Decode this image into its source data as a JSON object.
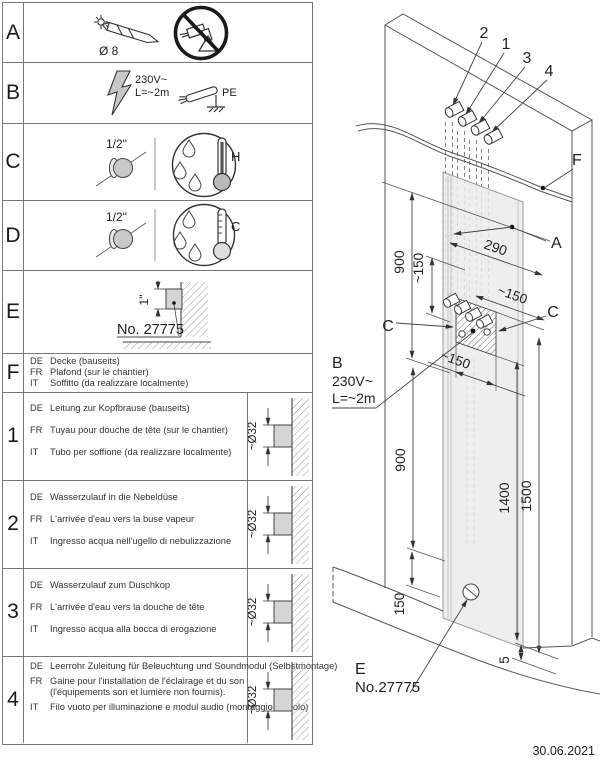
{
  "doc": {
    "date": "30.06.2021"
  },
  "table": {
    "langs": [
      "DE",
      "FR",
      "IT"
    ],
    "rowA": {
      "id": "A",
      "dia": "Ø 8"
    },
    "rowB": {
      "id": "B",
      "volt": "230V~",
      "length": "L=~2m",
      "pe": "PE"
    },
    "rowC": {
      "id": "C",
      "size": "1/2\"",
      "temp": "H"
    },
    "rowD": {
      "id": "D",
      "size": "1/2\"",
      "temp": "C"
    },
    "rowE": {
      "id": "E",
      "inch": "1\"",
      "no": "No. 27775"
    },
    "rowF": {
      "id": "F",
      "de": "Decke (bauseits)",
      "fr": "Plafond (sur le chantier)",
      "it": "Soffitto (da realizzare localmente)"
    },
    "row1": {
      "id": "1",
      "de": "Leitung zur Kopfbrause (bauseits)",
      "fr": "Tuyau pour douche de tête (sur le chantier)",
      "it": "Tubo per soffione (da realizzare localmente)",
      "dia": "~Ø32"
    },
    "row2": {
      "id": "2",
      "de": "Wasserzulauf in die Nebeldüse",
      "fr": "L'arrivée d'eau vers la buse vapeur",
      "it": "Ingresso acqua nell'ugello di nebulizzazione",
      "dia": "~Ø32"
    },
    "row3": {
      "id": "3",
      "de": "Wasserzulauf zum Duschkop",
      "fr": "L'arrivée d'eau vers la douche de tête",
      "it": "Ingresso acqua alla bocca di erogazione",
      "dia": "~Ø32"
    },
    "row4": {
      "id": "4",
      "de": "Leerrohr Zuleitung für Beleuchtung und Soundmodul (Selbstmontage)",
      "fr": "Gaine pour l'installation de l'éclairage et du son",
      "fr2": "(l'équipements son et lumière non fournis).",
      "it": "Filo vuoto per illuminazione e modul audio (montaggio da solo)",
      "dia": "~Ø32"
    }
  },
  "diagram": {
    "pipe2": "2",
    "pipe1": "1",
    "pipe3": "3",
    "pipe4": "4",
    "f": "F",
    "a": "A",
    "c_left": "C",
    "c_right": "C",
    "b": "B",
    "b_volt": "230V~",
    "b_len": "L=~2m",
    "e": "E",
    "e_no": "No.27775",
    "dim_900_top": "900",
    "dim_150_top": "~150",
    "dim_290": "290",
    "dim_150_diag": "~150",
    "dim_150_box": "~150",
    "dim_900_bottom": "900",
    "dim_1400": "1400",
    "dim_1500": "1500",
    "dim_150_floor": "150",
    "dim_5": "5"
  }
}
